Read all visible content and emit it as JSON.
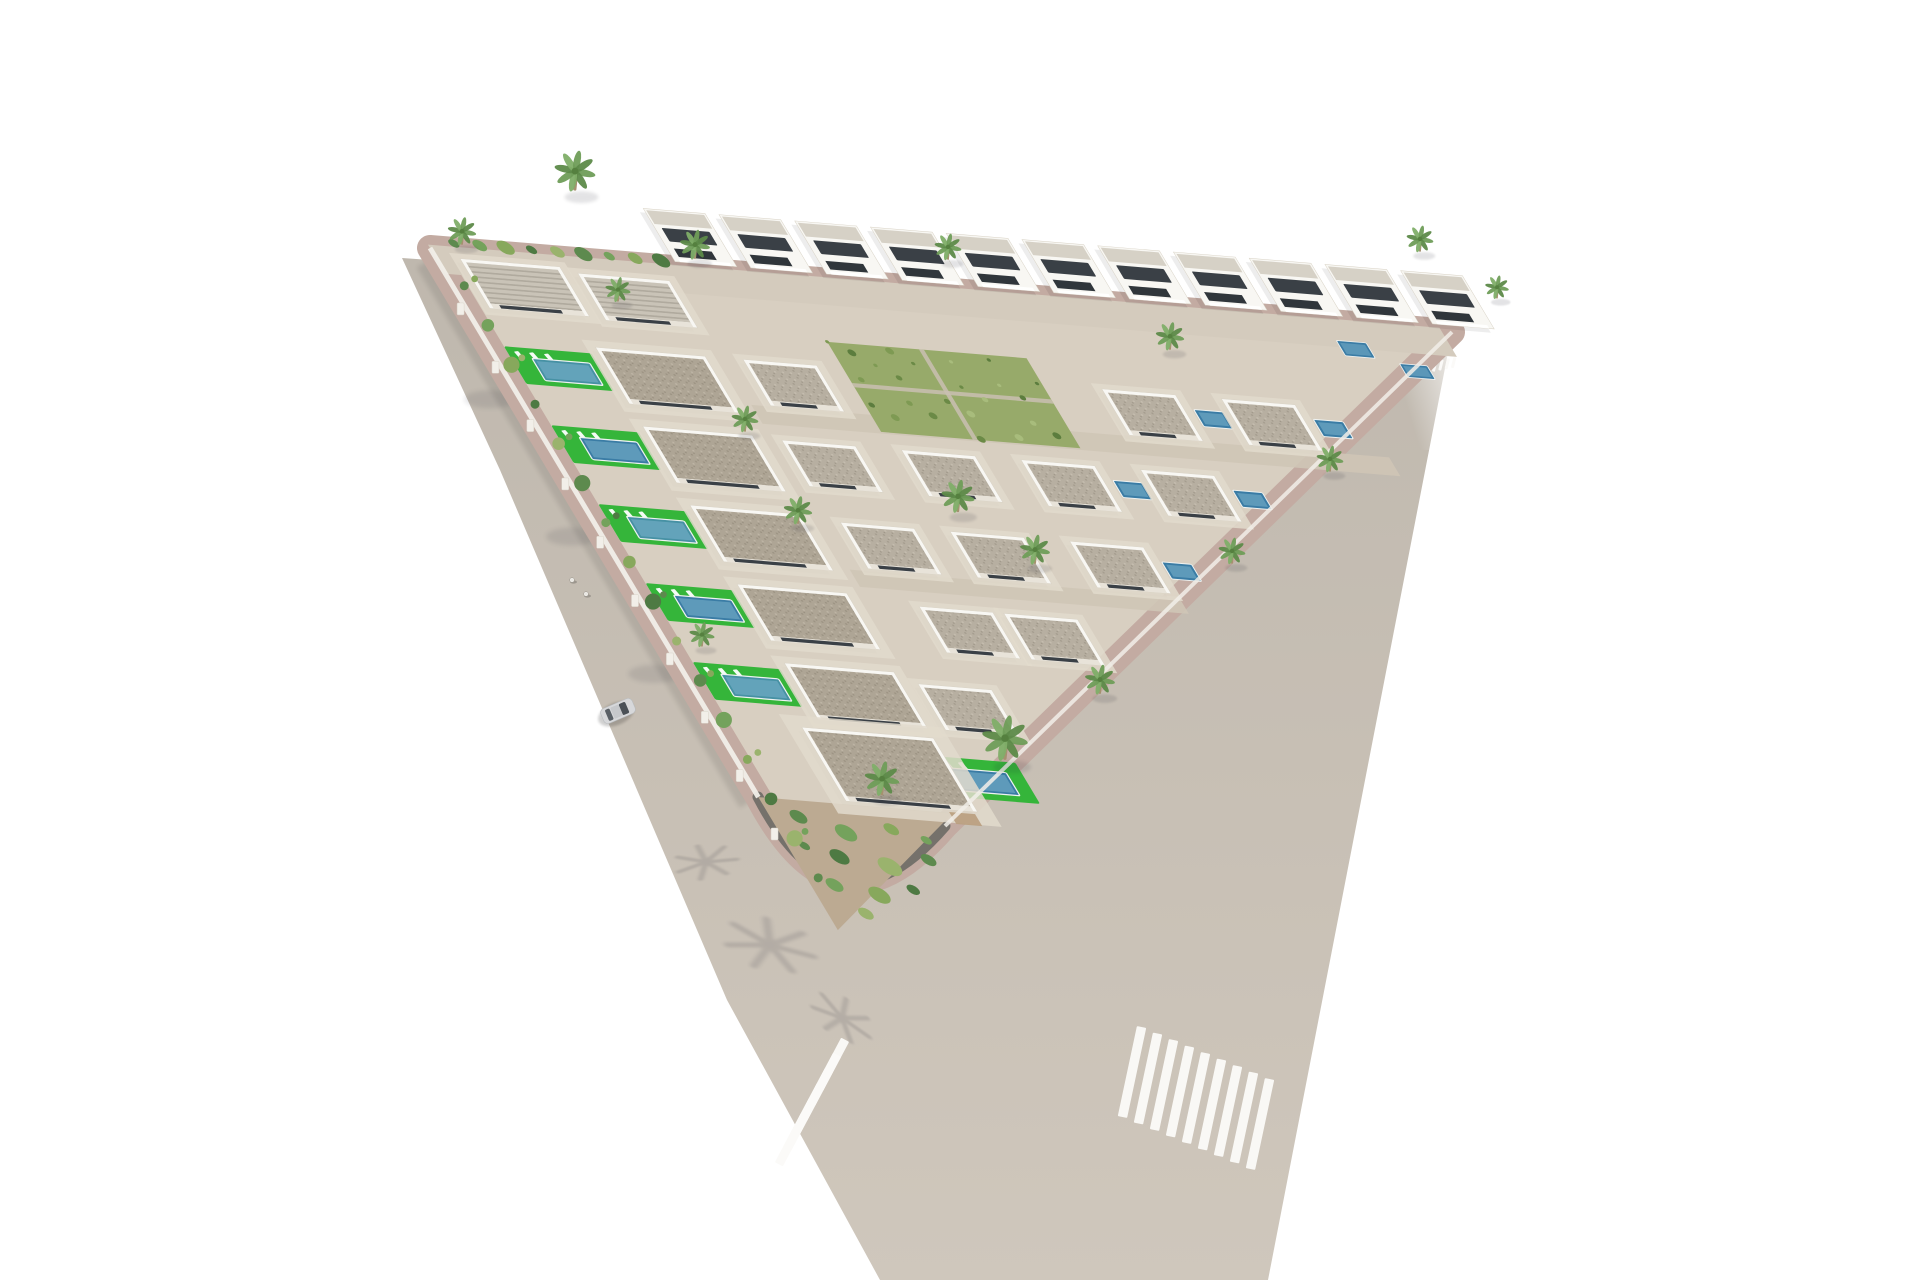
{
  "image": {
    "kind": "aerial-3d-architectural-render",
    "subject": "Triangular residential development of white Mediterranean villas with private pools, green lawns, palm trees, perimeter roads, zebra crosswalks and one car",
    "background": "#ffffff"
  },
  "colors": {
    "road_top": "#bfb8ae",
    "road_bottom": "#cfc7bc",
    "crosswalk": "#fbfaf8",
    "sidewalk": "#c3aba2",
    "wall_dark": "#6f6b66",
    "wall_white": "#f2efe9",
    "plot": "#d8cfc1",
    "plot_top_strip": "#d4cbbd",
    "street": "#cfc5b6",
    "terrace": "#e2dacc",
    "villa": "#f8f7f3",
    "villa_edge": "#d8d2c5",
    "roof_light": "#d6d1c6",
    "window": "#3a4046",
    "window2": "#30363b",
    "pool": "#3a7ca5",
    "pool_light": "#7cb2cc",
    "pool_teal": "#4691a4",
    "pool_edge": "#eef2f1",
    "lawn": "#35b53a",
    "veg_patch": "#97aa6a",
    "garden": "#bcaa92",
    "pergola": "#b99d7d",
    "trunk": "#a5916f",
    "palm_core": "#55803f",
    "car_body": "#d7d8da",
    "car_roof": "#c6c8cb",
    "car_glass": "#4b5157",
    "car_glass2": "#5a6066",
    "pedestrian": "#e9e7e2",
    "shrubs": [
      "#5d8a4e",
      "#74a25c",
      "#87a85c",
      "#4e7a43",
      "#9ab36d"
    ],
    "fronds": [
      "#6f9d58",
      "#5d8a49",
      "#7fae68"
    ]
  },
  "scene": {
    "plot_basis": {
      "origin": [
        430,
        248
      ],
      "u_axis": [
        0.9966,
        0.0819
      ],
      "w_axis": [
        0.513,
        0.858
      ],
      "u_len": 1025,
      "w_len": 795
    },
    "road_outline": [
      [
        402,
        258
      ],
      [
        500,
        470
      ],
      [
        727,
        1000
      ],
      [
        880,
        1280
      ],
      [
        1268,
        1280
      ],
      [
        1452,
        332
      ]
    ],
    "plot_outline": "M430,248 L1452,332 L945,826 Q838,950 758,797 Z",
    "corner_wall": "M758,797 Q838,950 945,826",
    "crosswalks": [
      {
        "name": "left-crosswalk",
        "cx": 812,
        "cy": 1102,
        "bars": 6,
        "bar_len": 56,
        "bar_w": 9,
        "rotate": 28,
        "step": [
          8,
          -15
        ]
      },
      {
        "name": "right-crosswalk",
        "cx": 1196,
        "cy": 1098,
        "bars": 9,
        "bar_len": 92,
        "bar_w": 9.5,
        "rotate": 12,
        "step": [
          16,
          6.5
        ]
      },
      {
        "name": "mini-crosswalk",
        "cx": 1441,
        "cy": 365,
        "bars": 5,
        "bar_len": 11,
        "bar_w": 3,
        "rotate": 14,
        "step": [
          6.3,
          -1.2
        ]
      }
    ],
    "green_patch": {
      "a": 360,
      "b": 75,
      "w": 200,
      "d": 105
    },
    "garden_pts": [
      [
        0,
        640
      ],
      [
        195,
        640
      ],
      [
        0,
        795
      ]
    ],
    "streets": [
      {
        "a": 240,
        "b": 160,
        "w": 640,
        "d": 22
      },
      {
        "a": 240,
        "b": 352,
        "w": 330,
        "d": 20
      }
    ],
    "villa_row_top": {
      "b": -70,
      "w": 62,
      "d": 62,
      "a_list": [
        250,
        326,
        402,
        478,
        554,
        630,
        706,
        782,
        858,
        934,
        1010
      ]
    },
    "villas": [
      {
        "a": 25,
        "b": 10,
        "w": 100,
        "d": 58,
        "t": "bungR"
      },
      {
        "a": 140,
        "b": 16,
        "w": 92,
        "d": 55,
        "t": "bungR"
      },
      {
        "a": 112,
        "b": 105,
        "w": 110,
        "d": 66,
        "t": "bigbung"
      },
      {
        "a": 112,
        "b": 197,
        "w": 110,
        "d": 66,
        "t": "bigbung"
      },
      {
        "a": 112,
        "b": 289,
        "w": 110,
        "d": 66,
        "t": "bigbung"
      },
      {
        "a": 112,
        "b": 381,
        "w": 110,
        "d": 66,
        "t": "bigbung"
      },
      {
        "a": 112,
        "b": 473,
        "w": 110,
        "d": 66,
        "t": "bigbung"
      },
      {
        "a": 260,
        "b": 105,
        "w": 74,
        "d": 54,
        "t": "bung"
      },
      {
        "a": 620,
        "b": 105,
        "w": 74,
        "d": 54,
        "t": "bung",
        "p": "S"
      },
      {
        "a": 740,
        "b": 105,
        "w": 74,
        "d": 54,
        "t": "bung",
        "p": "S"
      },
      {
        "a": 250,
        "b": 200,
        "w": 74,
        "d": 54,
        "t": "bung"
      },
      {
        "a": 370,
        "b": 200,
        "w": 74,
        "d": 54,
        "t": "bung"
      },
      {
        "a": 490,
        "b": 200,
        "w": 74,
        "d": 54,
        "t": "bung",
        "p": "S"
      },
      {
        "a": 610,
        "b": 200,
        "w": 74,
        "d": 54,
        "t": "bung",
        "p": "S"
      },
      {
        "a": 260,
        "b": 295,
        "w": 74,
        "d": 54,
        "t": "bung"
      },
      {
        "a": 370,
        "b": 295,
        "w": 74,
        "d": 54,
        "t": "bung"
      },
      {
        "a": 490,
        "b": 295,
        "w": 74,
        "d": 54,
        "t": "bung",
        "p": "S"
      },
      {
        "a": 290,
        "b": 390,
        "w": 74,
        "d": 54,
        "t": "bung"
      },
      {
        "a": 375,
        "b": 390,
        "w": 74,
        "d": 54,
        "t": "bung"
      },
      {
        "a": 240,
        "b": 485,
        "w": 74,
        "d": 54,
        "t": "bung"
      },
      {
        "a": 90,
        "b": 550,
        "w": 132,
        "d": 86,
        "t": "large"
      }
    ],
    "left_pools": {
      "a_lawn": 16,
      "a_pool": 38,
      "b_list": [
        113,
        205,
        297,
        389,
        481
      ]
    },
    "corner_pool": {
      "lawn": [
        195,
        572,
        98,
        48
      ],
      "pool": [
        215,
        585,
        62,
        27
      ]
    },
    "tiny_pools": [
      [
        898,
        22,
        30,
        18
      ],
      [
        950,
        44,
        28,
        16
      ]
    ],
    "palms": [
      [
        575,
        188,
        1.3
      ],
      [
        695,
        257,
        0.95
      ],
      [
        462,
        243,
        0.9
      ],
      [
        618,
        300,
        0.8
      ],
      [
        948,
        258,
        0.85
      ],
      [
        1170,
        348,
        0.9
      ],
      [
        1420,
        250,
        0.85
      ],
      [
        1497,
        297,
        0.75
      ],
      [
        958,
        510,
        1.05
      ],
      [
        1035,
        562,
        0.95
      ],
      [
        745,
        430,
        0.85
      ],
      [
        798,
        522,
        0.9
      ],
      [
        1330,
        470,
        0.85
      ],
      [
        1232,
        562,
        0.85
      ],
      [
        1005,
        757,
        1.45
      ],
      [
        882,
        793,
        1.1
      ],
      [
        1100,
        692,
        0.95
      ],
      [
        702,
        645,
        0.8
      ]
    ],
    "palm_shadows": [
      [
        770,
        945,
        1.9,
        15
      ],
      [
        706,
        862,
        1.3,
        -5
      ],
      [
        842,
        1018,
        1.4,
        35
      ]
    ],
    "car": {
      "x": 618,
      "y": 711,
      "rotate": 67
    },
    "pedestrians": [
      [
        572,
        580
      ],
      [
        586,
        594
      ]
    ]
  },
  "summary": {
    "villas_approx": 40,
    "private_pools_approx": 14,
    "crosswalks": 3,
    "cars": 1,
    "pedestrians": 2
  }
}
